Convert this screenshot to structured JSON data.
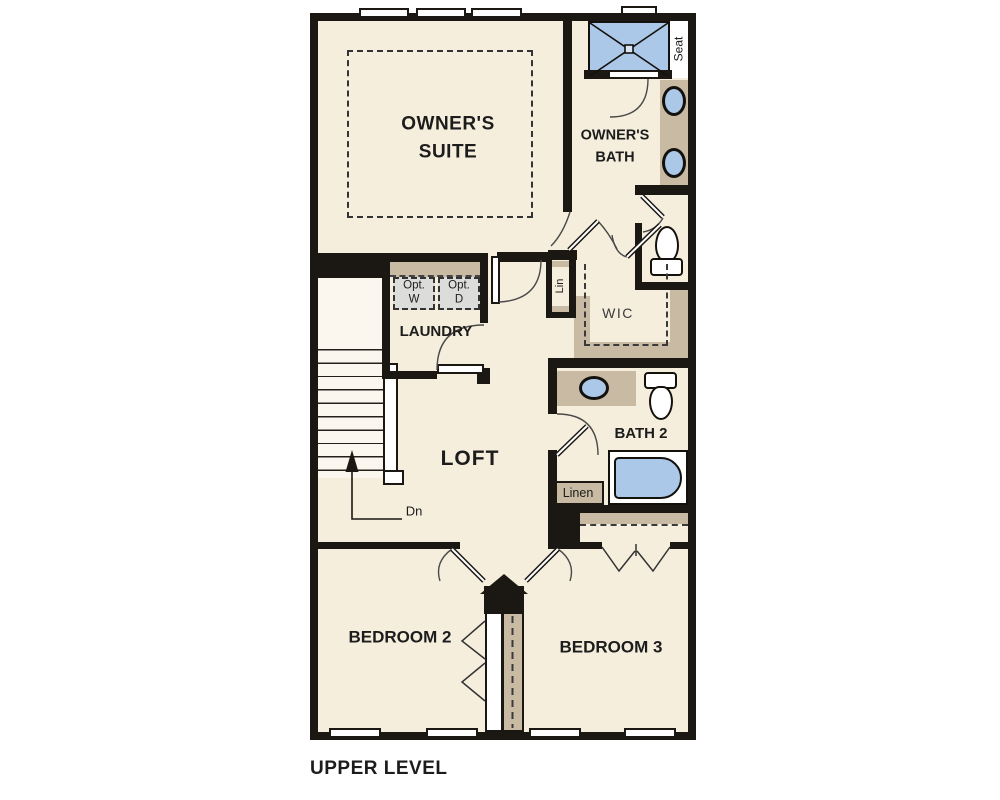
{
  "title": "UPPER LEVEL",
  "colors": {
    "wall": "#1b1712",
    "floor": "#f5eedd",
    "counter_tan": "#c9baa4",
    "fixture_blue": "#abc8e8",
    "optional_gray": "#dcdddb"
  },
  "rooms": {
    "owners_suite": {
      "line1": "OWNER'S",
      "line2": "SUITE"
    },
    "owners_bath": {
      "line1": "OWNER'S",
      "line2": "BATH"
    },
    "laundry": {
      "label": "LAUNDRY"
    },
    "loft": {
      "label": "LOFT"
    },
    "wic": {
      "label": "WIC"
    },
    "bath2": {
      "label": "BATH 2"
    },
    "bedroom2": {
      "label": "BEDROOM 2"
    },
    "bedroom3": {
      "label": "BEDROOM 3"
    }
  },
  "annotations": {
    "seat": "Seat",
    "lin": "Lin",
    "linen": "Linen",
    "down": "Dn",
    "opt_washer": {
      "line1": "Opt.",
      "line2": "W"
    },
    "opt_dryer": {
      "line1": "Opt.",
      "line2": "D"
    }
  }
}
